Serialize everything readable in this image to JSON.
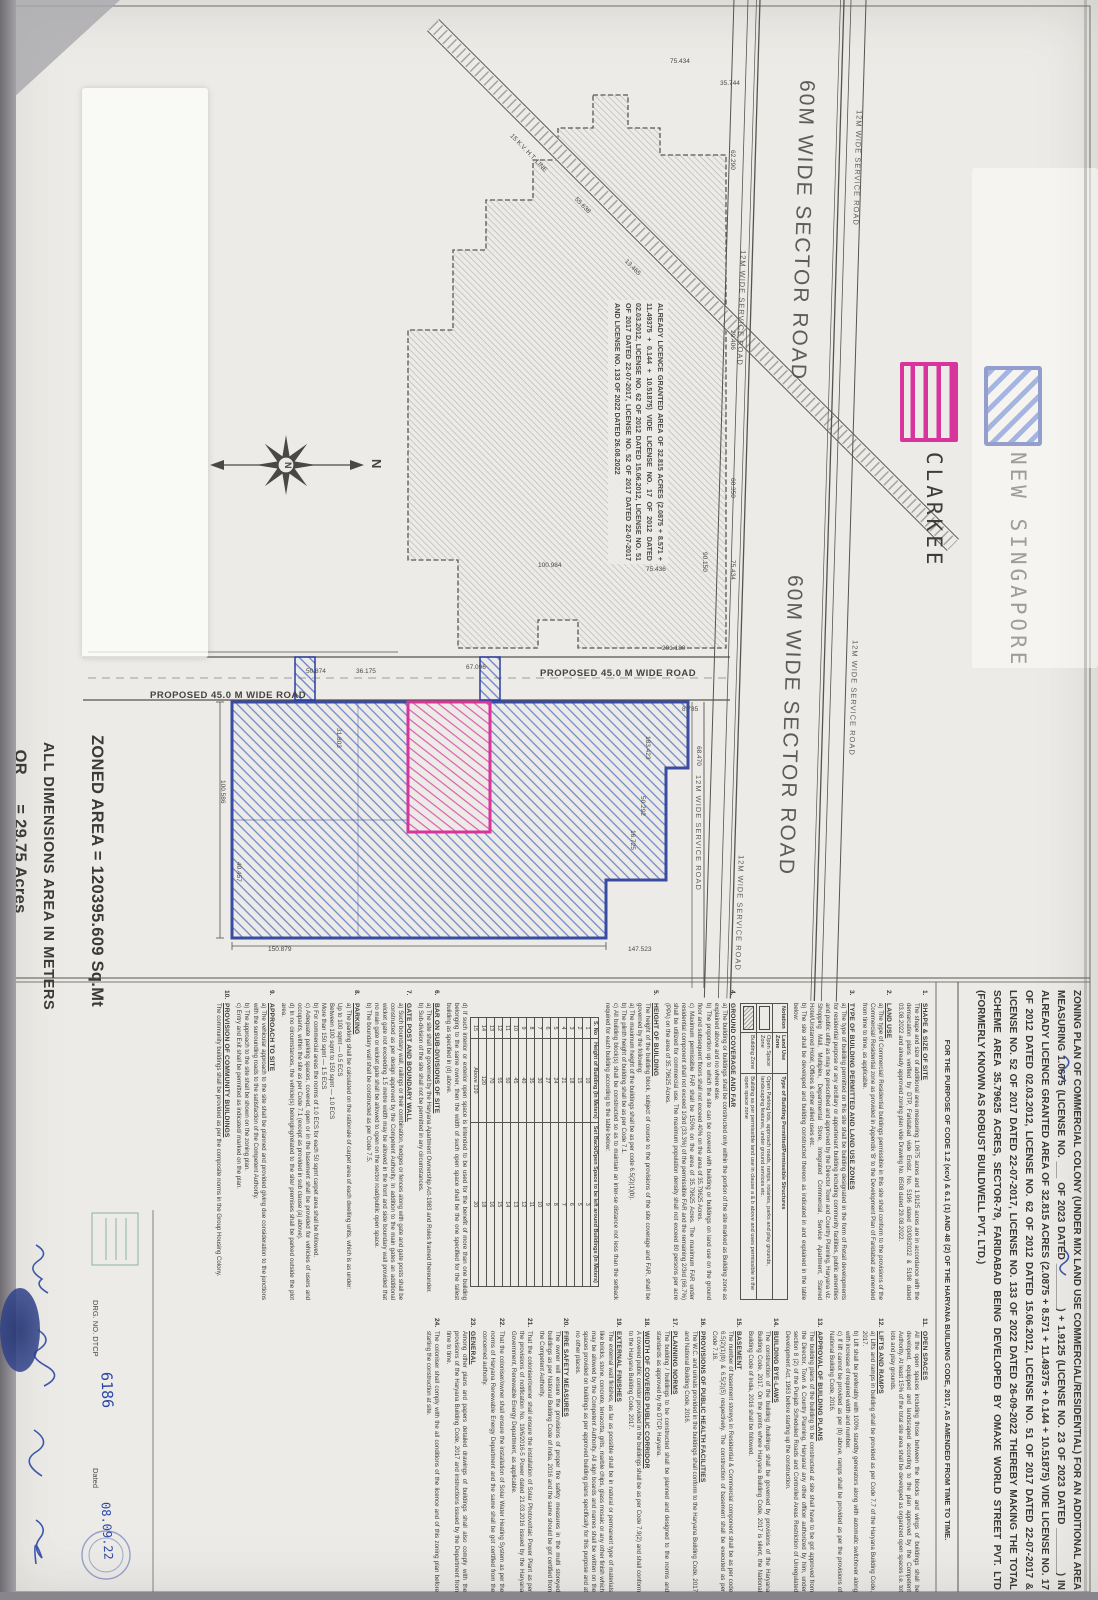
{
  "document": {
    "title_text": "ZONING PLAN OF COMMERCIAL COLONY (UNDER MIX LAND USE COMMERCIAL/RESIDENTIAL) FOR AN ADDITIONAL AREA MEASURING 1.0675 (LICENSE NO. ___ OF 2023 DATED ________) + 1.9125 (LICENSE NO. 23 OF 2023 DATED ________) IN ALREADY LICENCE GRANTED AREA OF 32.815 ACRES (2.0875 + 8.571 + 11.49375 + 0.144 + 10.51875) VIDE LICENSE NO. 17 OF 2012 DATED 02.03.2012, LICENSE NO. 62 OF 2012 DATED 15.06.2012, LICENSE NO. 51 OF 2017 DATED 22-07-2017 & LICENSE NO. 52 OF 2017 DATED 22-07-2017, LICENSE NO. 133 OF 2022 DATED 26-09-2022 THEREBY MAKING THE TOTAL SCHEME AREA 35.79625 ACRES, SECTOR-79, FARIDABAD BEING DEVELOPED BY OMAXE WORLD STREET PVT. LTD (FORMERLY KNOWN AS ROBUST BUILDWELL PVT. LTD.)",
    "purpose_line": "FOR THE PURPOSE OF CODE 1.2 (xcv) & 6.1 (1) AND 48 (2) OF THE HARYANA BUILDING CODE, 2017, AS AMENDED FROM TIME TO TIME."
  },
  "legend": {
    "items": [
      {
        "label": "NEW SINGAPORE",
        "color": "#2a3f9d",
        "pattern": "diagonal-hatch"
      },
      {
        "label": "CLARKEE",
        "color": "#d8359c",
        "pattern": "horizontal-stripes"
      }
    ]
  },
  "plan": {
    "sector_road_label": "60M WIDE SECTOR ROAD",
    "service_road_label": "12M WIDE SERVICE ROAD",
    "proposed_road_label": "PROPOSED 45.0 M WIDE ROAD",
    "ht_line_label": "15 K.V. H.T. LINE",
    "north_label": "N",
    "area_note": "ALREADY LICENCE GRANTED AREA OF 32.815 ACRES (2.0875 + 8.571 + 11.49375 + 0.144 + 10.51875) VIDE LICENSE NO. 17 OF 2012 DATED 02.03.2012, LICENSE NO. 62 OF 2012 DATED 15.06.2012, LICENSE NO. 51 OF 2017 DATED 22-07-2017, LICENSE NO. 52 OF 2017 DATED 22-07-2017 AND LICENSE NO. 133 OF 2022 DATED 26.08.2022",
    "zoned_area_line1": "ZONED AREA = 120395.609 Sq.Mt",
    "zoned_area_line2": "   OR      = 29.75 Acres",
    "dimensions_note": "ALL DIMENSIONS AREA IN METERS",
    "dimensions": [
      {
        "t": "62.290",
        "x": 150,
        "y": 362,
        "r": 0
      },
      {
        "t": "29.406",
        "x": 330,
        "y": 362,
        "r": 0
      },
      {
        "t": "60.350",
        "x": 478,
        "y": 362,
        "r": 0
      },
      {
        "t": "75.434",
        "x": 560,
        "y": 362,
        "r": 0
      },
      {
        "t": "75.434",
        "x": 58,
        "y": 428,
        "r": -90
      },
      {
        "t": "35.744",
        "x": 80,
        "y": 378,
        "r": -90
      },
      {
        "t": "90.150",
        "x": 552,
        "y": 390,
        "r": 0
      },
      {
        "t": "100.984",
        "x": 562,
        "y": 560,
        "r": -90
      },
      {
        "t": "75.436",
        "x": 566,
        "y": 452,
        "r": -90
      },
      {
        "t": "201.180",
        "x": 645,
        "y": 436,
        "r": -90
      },
      {
        "t": "8.785",
        "x": 706,
        "y": 416,
        "r": -90
      },
      {
        "t": "183.423",
        "x": 736,
        "y": 447,
        "r": 0
      },
      {
        "t": "50.292",
        "x": 796,
        "y": 452,
        "r": 0
      },
      {
        "t": "16.725",
        "x": 830,
        "y": 462,
        "r": 0
      },
      {
        "t": "68.470",
        "x": 746,
        "y": 396,
        "r": 0
      },
      {
        "t": "67.096",
        "x": 664,
        "y": 632,
        "r": -90
      },
      {
        "t": "36.175",
        "x": 668,
        "y": 742,
        "r": -90
      },
      {
        "t": "50.874",
        "x": 668,
        "y": 792,
        "r": -90
      },
      {
        "t": "31.803",
        "x": 728,
        "y": 756,
        "r": 0
      },
      {
        "t": "100.586",
        "x": 780,
        "y": 872,
        "r": 0
      },
      {
        "t": "40.457",
        "x": 862,
        "y": 856,
        "r": 0
      },
      {
        "t": "147.523",
        "x": 946,
        "y": 470,
        "r": -90
      },
      {
        "t": "150.879",
        "x": 946,
        "y": 830,
        "r": -90
      },
      {
        "t": "55.638",
        "x": 196,
        "y": 520,
        "r": -44
      },
      {
        "t": "13.465",
        "x": 258,
        "y": 470,
        "r": -44
      }
    ]
  },
  "land_use_table": {
    "headers": [
      "Notation",
      "Land Use Zone",
      "Type of Building Permitted/Permissible Structures"
    ],
    "rows": [
      {
        "swatch": "open",
        "zone": "Open Space Zone",
        "type": "Open Parking lots, approach roads, ramps, rotaries, parks and play grounds, landscaping features, under ground services etc."
      },
      {
        "swatch": "hatched",
        "zone": "Building Zone",
        "type": "Building as per permissible land use in clause a & b above and uses permissible in the open space zone"
      }
    ]
  },
  "setback_table": {
    "headers": [
      "S. No",
      "Height of Building (In Meters)",
      "Set Back/Open Space to be left around Buildings (In Meters)"
    ],
    "rows": [
      [
        "1",
        "10",
        "3"
      ],
      [
        "2",
        "15",
        "5"
      ],
      [
        "3",
        "18",
        "6"
      ],
      [
        "4",
        "21",
        "7"
      ],
      [
        "5",
        "24",
        "8"
      ],
      [
        "6",
        "27",
        "9"
      ],
      [
        "7",
        "30",
        "10"
      ],
      [
        "8",
        "35",
        "11"
      ],
      [
        "9",
        "40",
        "12"
      ],
      [
        "10",
        "45",
        "13"
      ],
      [
        "11",
        "50",
        "14"
      ],
      [
        "12",
        "55",
        "15"
      ],
      [
        "13",
        "70",
        "16"
      ],
      [
        "14",
        "120",
        "18"
      ],
      [
        "15",
        "Above 120",
        "20"
      ]
    ]
  },
  "notes": {
    "column_a": [
      {
        "num": "1.",
        "heading": "SHAPE & SIZE OF SITE",
        "body": "The shape and size of additional area measuring 1.0675 acres and 1.9125 acres are in accordance with the demarcation plans verified by DTP, Faridabad vide Endst. No. 5196 dated 03/08/2022 & 5198 dated 03.08.2022 and already approved zoning plan vide Drawing No. 8508 dated 29.08.2022."
      },
      {
        "num": "2.",
        "heading": "LAND USE",
        "body": "a) The type of Commercial/ Residential buildings permissible in this site shall conform to the provisions of the Commercial/ Residential zone as provided in Appendix 'B' to the Development Plan of Faridabad as amended from time to time, as applicable."
      },
      {
        "num": "3.",
        "heading": "TYPE OF BUILDING PERMITTED AND LAND USE ZONES",
        "body": "a) The type of building permitted on this site shall be building designated in the form of Retail developments for residential purpose or any ancillary or appurtenant building including community facilities, public amenities and public utility as may be prescribed and approved by the Director Town and Country Planning, Haryana viz. Shopping Mall, Multiplex, Departmental Store, Integrated Commercial, Service Apartment, Starred Hotel/Unstarred Hotel, Offices & other allied uses etc.\nb) The site shall be developed and building constructed thereon as indicated in and explained in the table below:",
        "table": "land_use"
      },
      {
        "num": "4.",
        "heading": "GROUND COVERAGE AND FAR",
        "body": "a) The building or buildings shall be constructed only within the portion of the site marked as Building zone as explained above and no where else.\nb) The proportion up to which the site can be covered with building or buildings on land use on the ground floor and subsequent floors shall not exceed 40% on the area of 35.79625 Acres.\nc) Maximum permissible FAR shall be 150% on the area of 35.79625 Acres. The maximum FAR under residential component shall not exceed 1/3rd (33.3%) of the permissible FAR and the remaining 2/3rd (66.7%) shall be utilized for commercial use. The maximum population density shall not exceed 80 persons per acre (PPA) on the area of 35.79625 Acres."
      },
      {
        "num": "5.",
        "heading": "HEIGHT OF BUILDING",
        "body": "The height of the building block, subject of course to the provisions of the site coverage and FAR, shall be governed by the following:\na) The maximum height of the buildings shall be as per code 6.5(2)(1)(b).\nb) The plinth height of building shall be as per Code 7.1.\nc) All building block(s) shall be constructed so as to maintain an inter-se distance not less than the setback required for each building according to the table below:",
        "table": "setback",
        "after": "d) If such interior or exterior open space is intended to be used for the benefit of more than one building belonging to the same owner, then the width of such open space shall be the one specified for the tallest building as specified in (d) above."
      },
      {
        "num": "6.",
        "heading": "BAR ON SUB-DIVISIONS OF SITE",
        "body": "a) The site shall be governed by the Haryana Apartment Ownership Act-1983 and Rules framed thereunder.\nb) Sub-division of the site shall not be permitted in any circumstances."
      },
      {
        "num": "7.",
        "heading": "GATE POST AND BOUNDARY WALL",
        "body": "a) Such boundary wall, railings or their combination, hedges or fences along with gate and gate posts shall be constructed as per design approved by the Competent Authority. In addition to the main gates an additional wicket gate not exceeding 1.5 metre width may be allowed in the front and side boundary wall provided that no main gate or wicket gate shall be allowed to open on the sector road/public open space.\nb) The boundary wall shall be constructed as per Code 7.5."
      },
      {
        "num": "8.",
        "heading": "PARKING",
        "body": "a) The parking shall be calculated on the rationale of carpet area of each dwelling units, which is as under:\nUp to 100 sqmt — 0.5 ECS\nBetween 100 sqmt to 150 sqmt — 1.0 ECS\nMore than 150 sqmt — 1.5 ECS\nb) For commercial areas the norms of 1.0 ECS for each 50 sqmt carpet area shall be followed.\nc) Adequate parking spaces, covered, open or in the basement shall be provided for vehicles of users and occupants, within the site as per Code 7.1 (except as provided in sub clause (a) above).\nd) In no circumstances, the vehicle(s) belonging/related to the site/ premises shall be parked outside the plot area."
      },
      {
        "num": "9.",
        "heading": "APPROACH TO SITE",
        "body": "a) The vehicular approach to the site shall be planned and provided giving due consideration to the junctions with the surrounding roads to the satisfaction of the Competent Authority.\nb) The approach to the site shall be shown on the zoning plan.\nc) Entry and Exit shall be permitted as indicated/ marked on the plan."
      },
      {
        "num": "10.",
        "heading": "PROVISION OF COMMUNITY BUILDINGS",
        "body": "The community buildings shall be provided as per the composite norms in the Group Housing Colony."
      }
    ],
    "column_b": [
      {
        "num": "11.",
        "heading": "OPEN SPACES",
        "body": "All the open spaces including those between the blocks and wings of buildings shall be developed, equipped and landscaped according to the plan approved by the Competent Authority. At least 15% of the total site area shall be developed as organized open spaces i.e. tot lots and play grounds."
      },
      {
        "num": "12.",
        "heading": "LIFTS AND RAMPS",
        "body": "a) Lifts and ramps in building shall be provided as per Code 7.7 of the Haryana Building Code, 2017.\nb) Lift shall be preferably with 100% standby generators along with automatic switchover along with increase of required width and number.\nc) If lift cannot be provided as per (b) above, ramps shall be provided as per the provisions of National Building Code, 2016."
      },
      {
        "num": "13.",
        "heading": "APPROVAL OF BUILDING PLANS",
        "body": "The building plans of the building to be constructed at site shall have to be got approved from the Director, Town & Country Planning, Haryana/ any other officer authorized by him, under section 8 (2) of the Punjab Scheduled Roads and Controlled Areas Restriction of Unregulated Development Act, 1963 before starting up the construction."
      },
      {
        "num": "14.",
        "heading": "BUILDING BYE-LAWS",
        "body": "The construction of the building /buildings shall be governed by provisions of the Haryana Building Code, 2017. On the points where Haryana Building Code, 2017 is silent, the National Building Code of India, 2016 shall be followed."
      },
      {
        "num": "15.",
        "heading": "BASEMENT",
        "body": "The number of basement storeys in Residential & Commercial component shall be as per code 6.5(2)(1)(b) & 6.5(2)(5) respectively. The construction of basement shall be executed as per Code 7.16."
      },
      {
        "num": "16.",
        "heading": "PROVISIONS OF PUBLIC HEALTH FACILITIES",
        "body": "The W.C. and urinals provided in the buildings shall conform to the Haryana Building Code, 2017 and National Building Code, 2016."
      },
      {
        "num": "17.",
        "heading": "PLANNING NORMS",
        "body": "The building / buildings to be constructed shall be planned and designed to the norms and standards as approved by the DTCP, Haryana."
      },
      {
        "num": "18.",
        "heading": "WIDTH OF COVERED PUBLIC CORRIDOR",
        "body": "A covered public corridor provided in the buildings shall be as per Code 7.9(2) and shall conform to the Haryana Building Code, 2017."
      },
      {
        "num": "19.",
        "heading": "EXTERNAL FINISHES",
        "body": "The external wall finishes, as far as possible shall be in natural or permanent type of materials like bricks, stone, concrete, terracotta, grits, marble chips, glass mosaic or any other finish which may be allowed by the Competent Authority. All sign boards and names shall be written on the spaces provided on buildings as per approved building plans specifically for this purpose and at no other places."
      },
      {
        "num": "20.",
        "heading": "FIRE SAFETY MEASURES",
        "body": "The owner will ensure the provisions of proper fire safety measures in the multi storeyed buildings as per National Building Code of India, 2016 and the same should be got certified from the Competent Authority."
      },
      {
        "num": "21.",
        "heading": "",
        "body": "That the coloniser/owner shall ensure the installation of Solar Photovoltaic Power Plant as per the provisions of notification No. 19/6/2016-5 Power dated 21.03.2016 issued by the Haryana Government, Renewable Energy Department, as applicable."
      },
      {
        "num": "22.",
        "heading": "",
        "body": "That the coloniser/owner shall ensure the installation of Solar Water Heating System as per the norms of Haryana Renewable Energy Department and the same shall be got certified from the concerned authority."
      },
      {
        "num": "23.",
        "heading": "GENERAL",
        "body": "Among other plans and papers detailed drawings of buildings shall also comply with the provisions of the Haryana Building Code, 2017 and instructions issued by the Department from time to time."
      },
      {
        "num": "24.",
        "heading": "",
        "body": "The coloniser shall comply with the all conditions of the licence and of this zoning plan before starting the construction at site."
      }
    ]
  },
  "signature_block": {
    "drg_label": "DRG. NO. DTCP",
    "drg_value": "6186",
    "dated_label": "Dated",
    "dated_value": "08.09.22"
  }
}
